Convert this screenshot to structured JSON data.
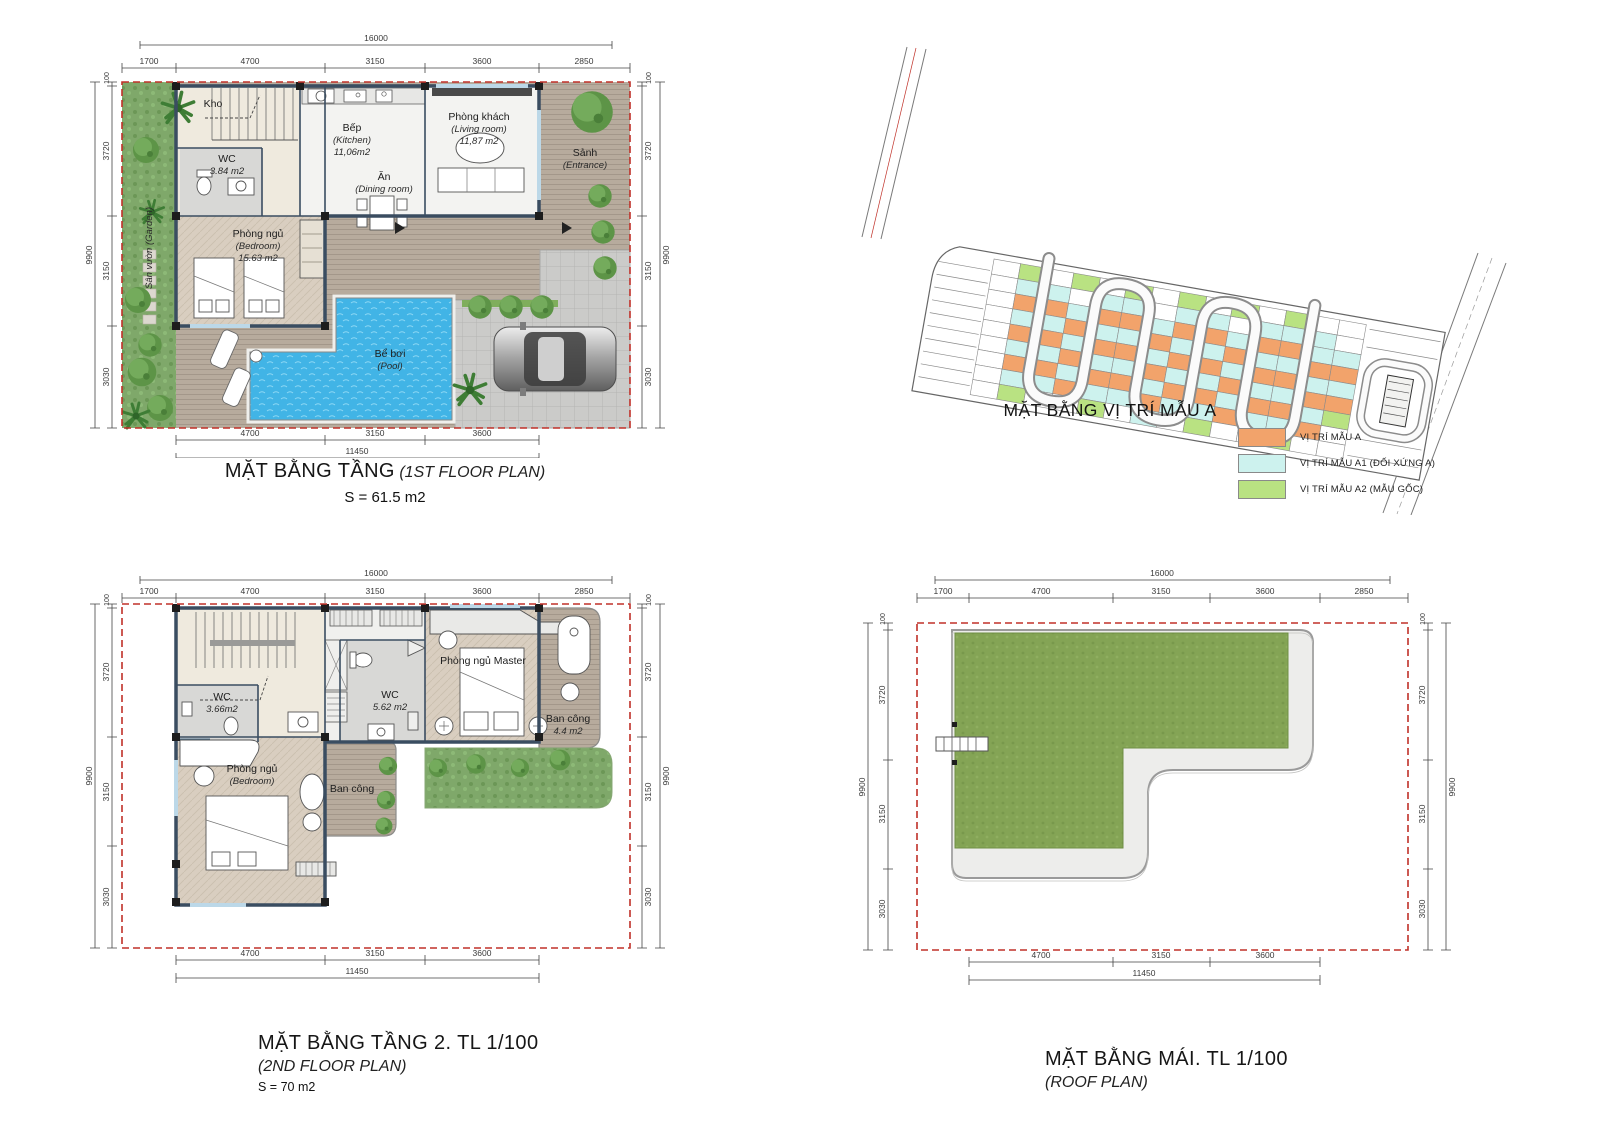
{
  "floor1": {
    "title": "MẶT BẰNG TẦNG",
    "subtitle": "(1ST FLOOR PLAN)",
    "area_label": "S = 61.5 m2",
    "dims": {
      "top_total": "16000",
      "top": [
        "1700",
        "4700",
        "3150",
        "3600",
        "2850"
      ],
      "left_total": "9900",
      "left": [
        "100",
        "3720",
        "3150",
        "3030"
      ],
      "right_total": "9900",
      "right": [
        "100",
        "3720",
        "3150",
        "3030"
      ],
      "bottom": [
        "4700",
        "3150",
        "3600"
      ],
      "bottom_total": "11450"
    },
    "rooms": {
      "kho": "Kho",
      "wc_name": "WC",
      "wc_area": "3.84 m2",
      "kitchen_name": "Bếp",
      "kitchen_en": "(Kitchen)",
      "kitchen_area": "11,06m2",
      "dining_name": "Ăn",
      "dining_en": "(Dining room)",
      "living_name": "Phòng khách",
      "living_en": "(Living room)",
      "living_area": "11,87 m2",
      "entrance_name": "Sảnh",
      "entrance_en": "(Entrance)",
      "bedroom_name": "Phòng ngủ",
      "bedroom_en": "(Bedroom)",
      "bedroom_area": "15.63 m2",
      "garden_name": "Sân vườn (Garden)",
      "pool_name": "Bể bơi",
      "pool_en": "(Pool)"
    }
  },
  "site": {
    "title": "MẶT BẰNG VỊ TRÍ MẪU A",
    "legend": [
      {
        "color": "#f2a36b",
        "label": "VỊ TRÍ MẪU A"
      },
      {
        "color": "#cdf2ee",
        "label": "VỊ TRÍ MẪU A1 (ĐỐI XỨNG A)"
      },
      {
        "color": "#b9e282",
        "label": "VỊ TRÍ MẪU A2 (MẪU GỐC)"
      }
    ],
    "lot_colors": {
      "o": "#f2a36b",
      "c": "#cdf2ee",
      "g": "#b9e282",
      "w": "#ffffff"
    },
    "lot_matrix": [
      "wwwwwwwww",
      "gcocococg",
      "wcocococw",
      "gwcococow",
      "wcocococg",
      "gcocococw",
      "wwcocococ",
      "gcocococw",
      "wcocococg",
      "gwcococow",
      "wcocococw",
      "gcocococg",
      "wccococow",
      "wwcocogww"
    ]
  },
  "floor2": {
    "title": "MẶT BẰNG TẦNG 2. TL 1/100",
    "subtitle": "(2ND FLOOR PLAN)",
    "area_label": "S = 70 m2",
    "dims": {
      "top_total": "16000",
      "top": [
        "1700",
        "4700",
        "3150",
        "3600",
        "2850"
      ],
      "left_total": "9900",
      "left": [
        "100",
        "3720",
        "3150",
        "3030"
      ],
      "right_total": "9900",
      "right": [
        "100",
        "3720",
        "3150",
        "3030"
      ],
      "bottom": [
        "4700",
        "3150",
        "3600"
      ],
      "bottom_total": "11450"
    },
    "rooms": {
      "wc1_name": "WC",
      "wc1_area": "3.66m2",
      "wc2_name": "WC",
      "wc2_area": "5.62 m2",
      "master_name": "Phòng ngủ Master",
      "balcony1_name": "Ban công",
      "balcony1_area": "4.4 m2",
      "bedroom_name": "Phòng ngủ",
      "bedroom_en": "(Bedroom)",
      "balcony2_name": "Ban công"
    }
  },
  "roof": {
    "title": "MẶT BẰNG MÁI. TL 1/100",
    "subtitle": "(ROOF PLAN)",
    "dims": {
      "top_total": "16000",
      "top": [
        "1700",
        "4700",
        "3150",
        "3600",
        "2850"
      ],
      "left_total": "9900",
      "left": [
        "100",
        "3720",
        "3150",
        "3030"
      ],
      "right_total": "9900",
      "right": [
        "100",
        "3720",
        "3150",
        "3030"
      ],
      "bottom": [
        "4700",
        "3150",
        "3600"
      ],
      "bottom_total": "11450"
    }
  }
}
